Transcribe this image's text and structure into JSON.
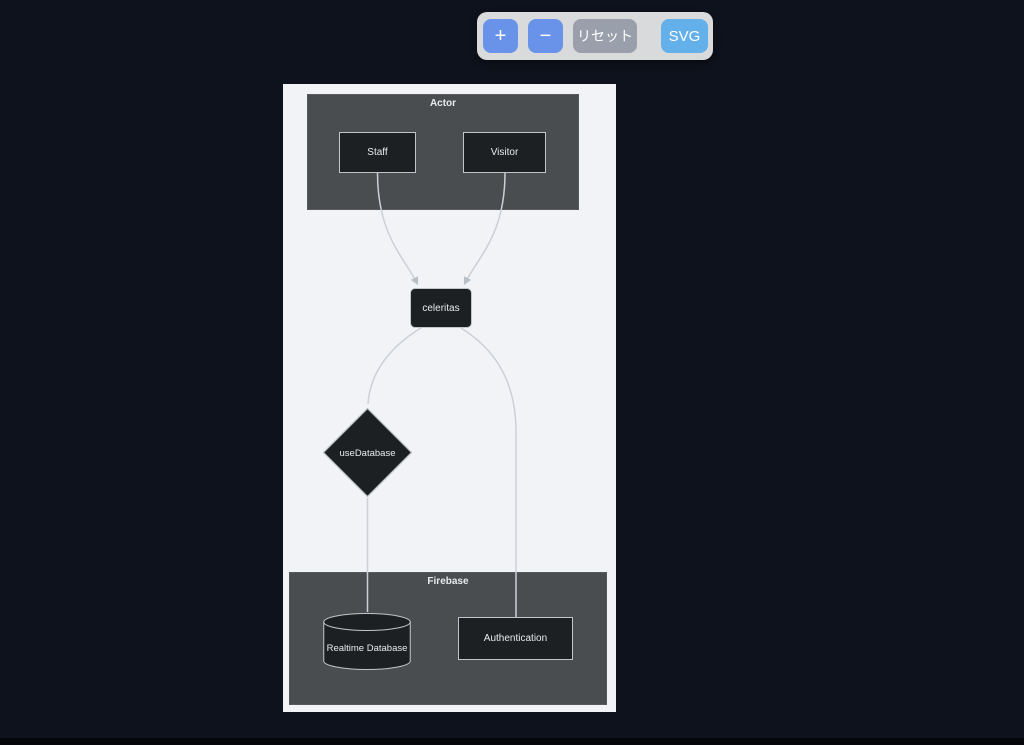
{
  "toolbar": {
    "zoom_in_label": "+",
    "zoom_out_label": "−",
    "reset_label": "リセット",
    "export_label": "SVG"
  },
  "diagram": {
    "clusters": [
      {
        "id": "actor",
        "label": "Actor"
      },
      {
        "id": "firebase",
        "label": "Firebase"
      }
    ],
    "nodes": [
      {
        "id": "staff",
        "label": "Staff",
        "shape": "rect",
        "cluster": "actor"
      },
      {
        "id": "visitor",
        "label": "Visitor",
        "shape": "rect",
        "cluster": "actor"
      },
      {
        "id": "celeritas",
        "label": "celeritas",
        "shape": "rounded-rect",
        "cluster": null
      },
      {
        "id": "useDatabase",
        "label": "useDatabase",
        "shape": "diamond",
        "cluster": null
      },
      {
        "id": "realtime-database",
        "label": "Realtime Database",
        "shape": "cylinder",
        "cluster": "firebase"
      },
      {
        "id": "authentication",
        "label": "Authentication",
        "shape": "rect",
        "cluster": "firebase"
      }
    ],
    "edges": [
      {
        "from": "Staff",
        "to": "celeritas",
        "arrowhead": true
      },
      {
        "from": "Visitor",
        "to": "celeritas",
        "arrowhead": true
      },
      {
        "from": "celeritas",
        "to": "useDatabase",
        "arrowhead": false
      },
      {
        "from": "celeritas",
        "to": "Authentication",
        "arrowhead": false
      },
      {
        "from": "useDatabase",
        "to": "Realtime Database",
        "arrowhead": false
      }
    ]
  },
  "colors": {
    "page-bg": "#0e121c",
    "bottom-bar": "#05070b",
    "canvas-bg": "#f1f3f6",
    "cluster-fill": "#4a4d4f",
    "cluster-border": "#565a5d",
    "node-fill": "#1d2023",
    "node-border": "#c2c5c9",
    "node-text": "#e9eaec",
    "edge": "#ccd0d6",
    "toolbar-bg": "#d9dadc",
    "btn-zoom": "#6993e9",
    "btn-reset": "#99a0ab",
    "btn-export": "#64b0ea",
    "btn-text": "#ffffff"
  }
}
